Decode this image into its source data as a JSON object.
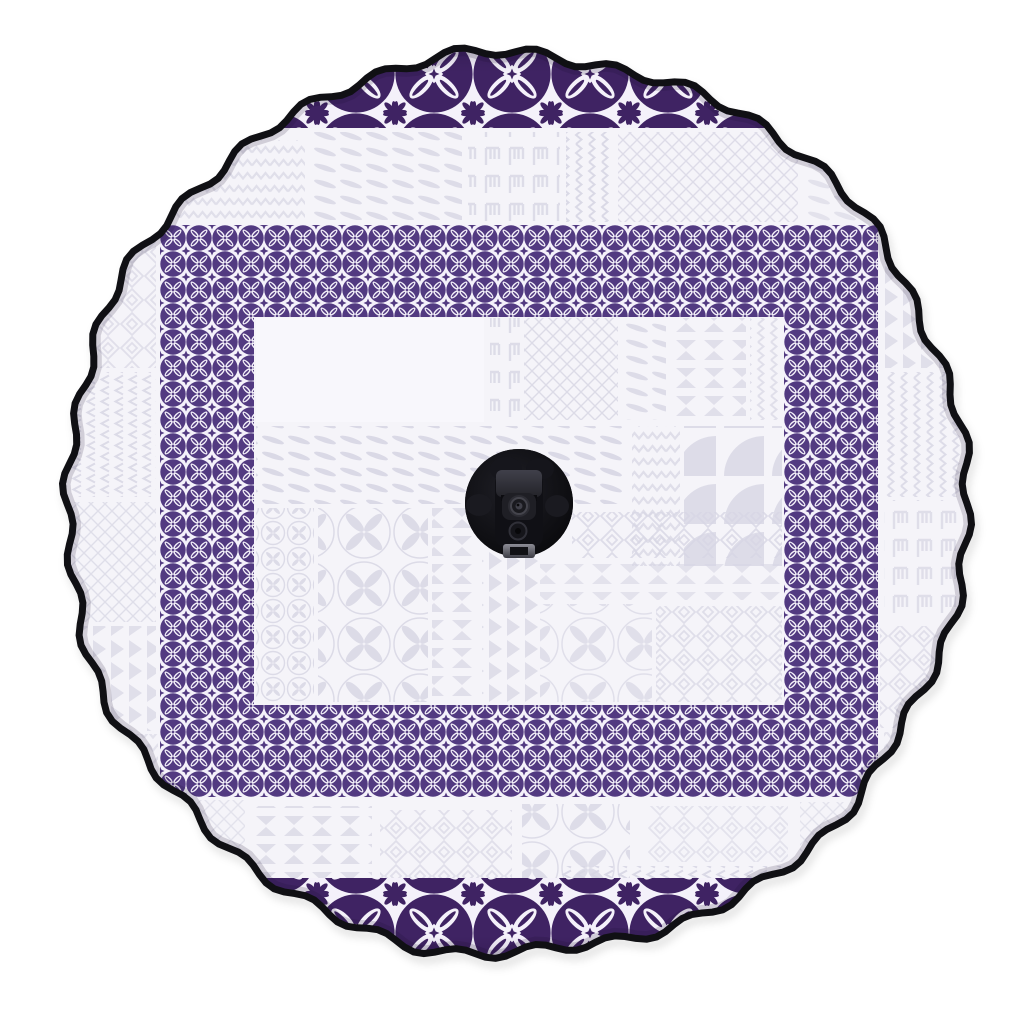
{
  "scene": {
    "type": "product-photo",
    "subject": "spare-tire-cover",
    "design": "polynesian-tapa-patchwork",
    "elements": {
      "edge": "scalloped-black-elastic-rim",
      "border": "dark-purple-siapo-flower-square-frame",
      "top_band": "large-purple-flower-crescent",
      "bottom_band": "large-purple-flower-crescent",
      "background": "faint-lavender-tapa-motif-patchwork",
      "center": "backup-camera-opening"
    }
  },
  "colors": {
    "page_bg": "#ffffff",
    "cover_base": "#f5f4f9",
    "white_block": "#f8f7fc",
    "tile_white": "#f4f1fa",
    "faint": "#d7d6e4",
    "purple_frame": "#523a81",
    "purple_crescent": "#3f2363",
    "rim": "#101014",
    "hole": "#0a0a0d",
    "camera_body": "#1d1d23",
    "camera_head": "#34343c",
    "metal": "#73737c"
  },
  "geometry": {
    "cx": 516,
    "cy": 504,
    "radius": 450,
    "rim_width": 7,
    "wave1_n": 36,
    "wave1_amp": 5,
    "wave2_n": 7,
    "wave2_amp": 3.2,
    "wave3_n": 13,
    "wave3_amp": 2.2,
    "camera_cx": 519,
    "camera_cy": 503,
    "camera_r": 54
  }
}
